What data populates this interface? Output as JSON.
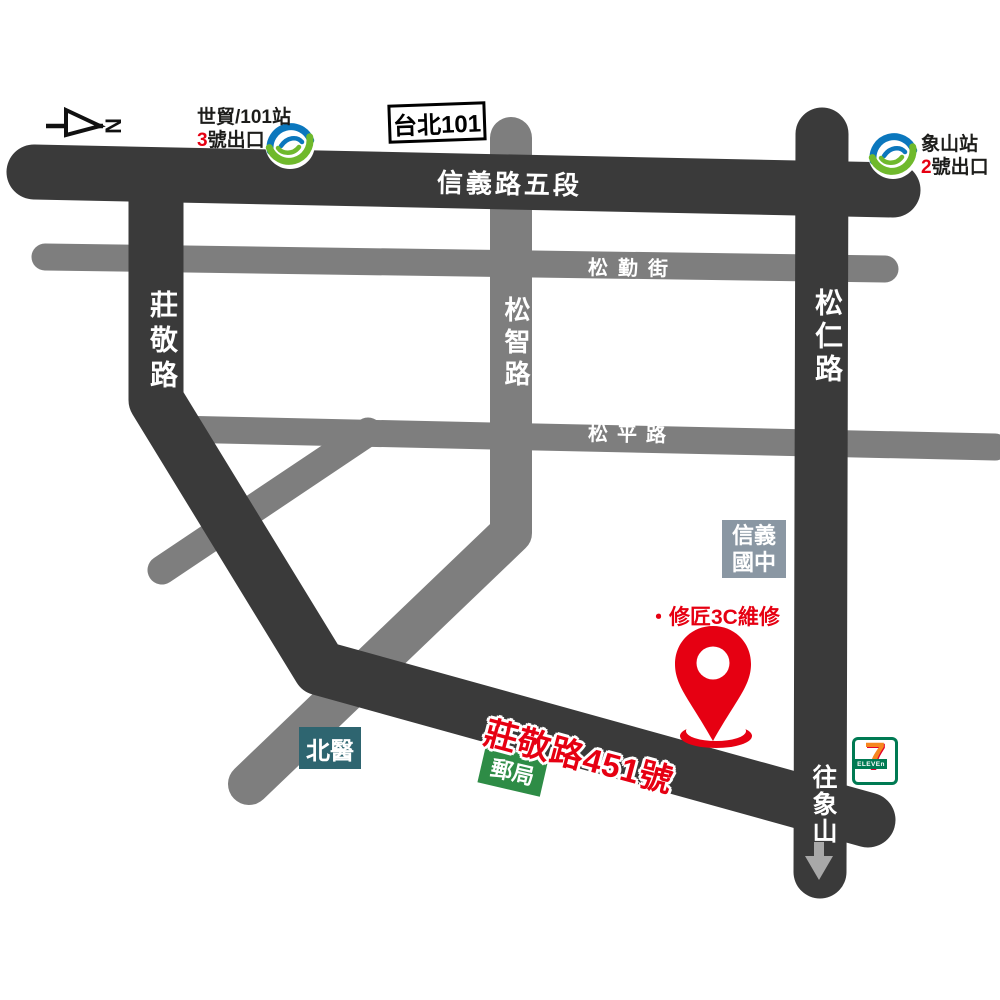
{
  "compass": {
    "north_label": "N"
  },
  "roads": {
    "xinyi_rd_5": "信義路五段",
    "songqin_st": "松勤街",
    "zhuangjing_rd": "莊敬路",
    "songzhi_rd": "松智路",
    "songren_rd": "松仁路",
    "songping_rd": "松平路"
  },
  "stations": {
    "s1": {
      "line1": "世貿/101站",
      "exit_no": "3",
      "exit_suffix": "號出口"
    },
    "s2": {
      "name": "象山站",
      "exit_no": "2",
      "exit_suffix": "號出口"
    }
  },
  "landmarks": {
    "taipei101": "台北101",
    "school_line1": "信義",
    "school_line2": "國中",
    "hospital": "北醫",
    "post_office": "郵局",
    "shop": "・修匠3C維修",
    "address": "莊敬路451號",
    "toward_xiangshan": "往象山",
    "seven_digit": "7",
    "seven_word": "ELEVEn"
  },
  "colors": {
    "road_dark": "#3a3a3a",
    "road_gray": "#7e7e7e",
    "accent_red": "#e60012",
    "school_bg": "#8a97a3",
    "hospital_bg": "#2e6570",
    "post_bg": "#2e8c46",
    "metro_blue": "#0b77bd",
    "metro_green": "#6fb92c",
    "seven_green": "#007a53",
    "seven_orange": "#f6861f",
    "seven_red": "#e4002b",
    "arrow_gray": "#a8a8a8",
    "text_dark": "#1d1d1b"
  }
}
